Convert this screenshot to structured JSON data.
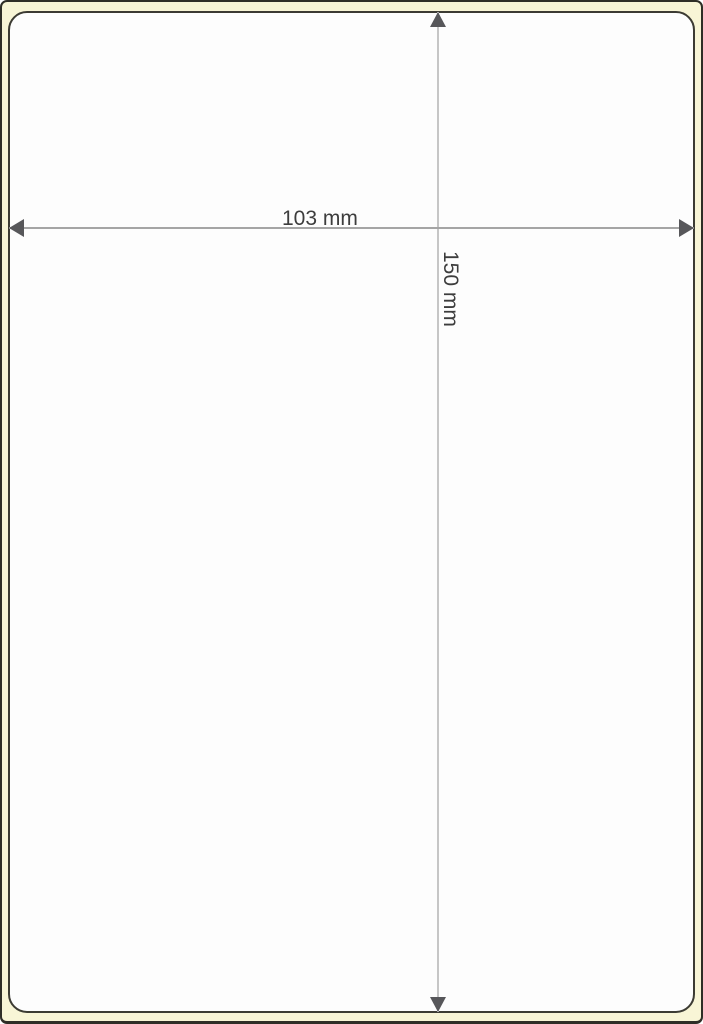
{
  "dimensions": {
    "width_label": "103 mm",
    "height_label": "150 mm"
  },
  "icons": {
    "up": "arrowhead-up-icon",
    "down": "arrowhead-down-icon",
    "left": "arrowhead-left-icon",
    "right": "arrowhead-right-icon"
  },
  "colors": {
    "backing_sheet": "#f8f5d6",
    "outer_border": "#2f2e27",
    "label_border": "#3c3b33",
    "label_fill": "#fdfdfd",
    "arrowhead": "#57575a",
    "width_line": "#a5a5a5",
    "height_line": "#c6c6c6",
    "text": "#3d3d3d"
  }
}
